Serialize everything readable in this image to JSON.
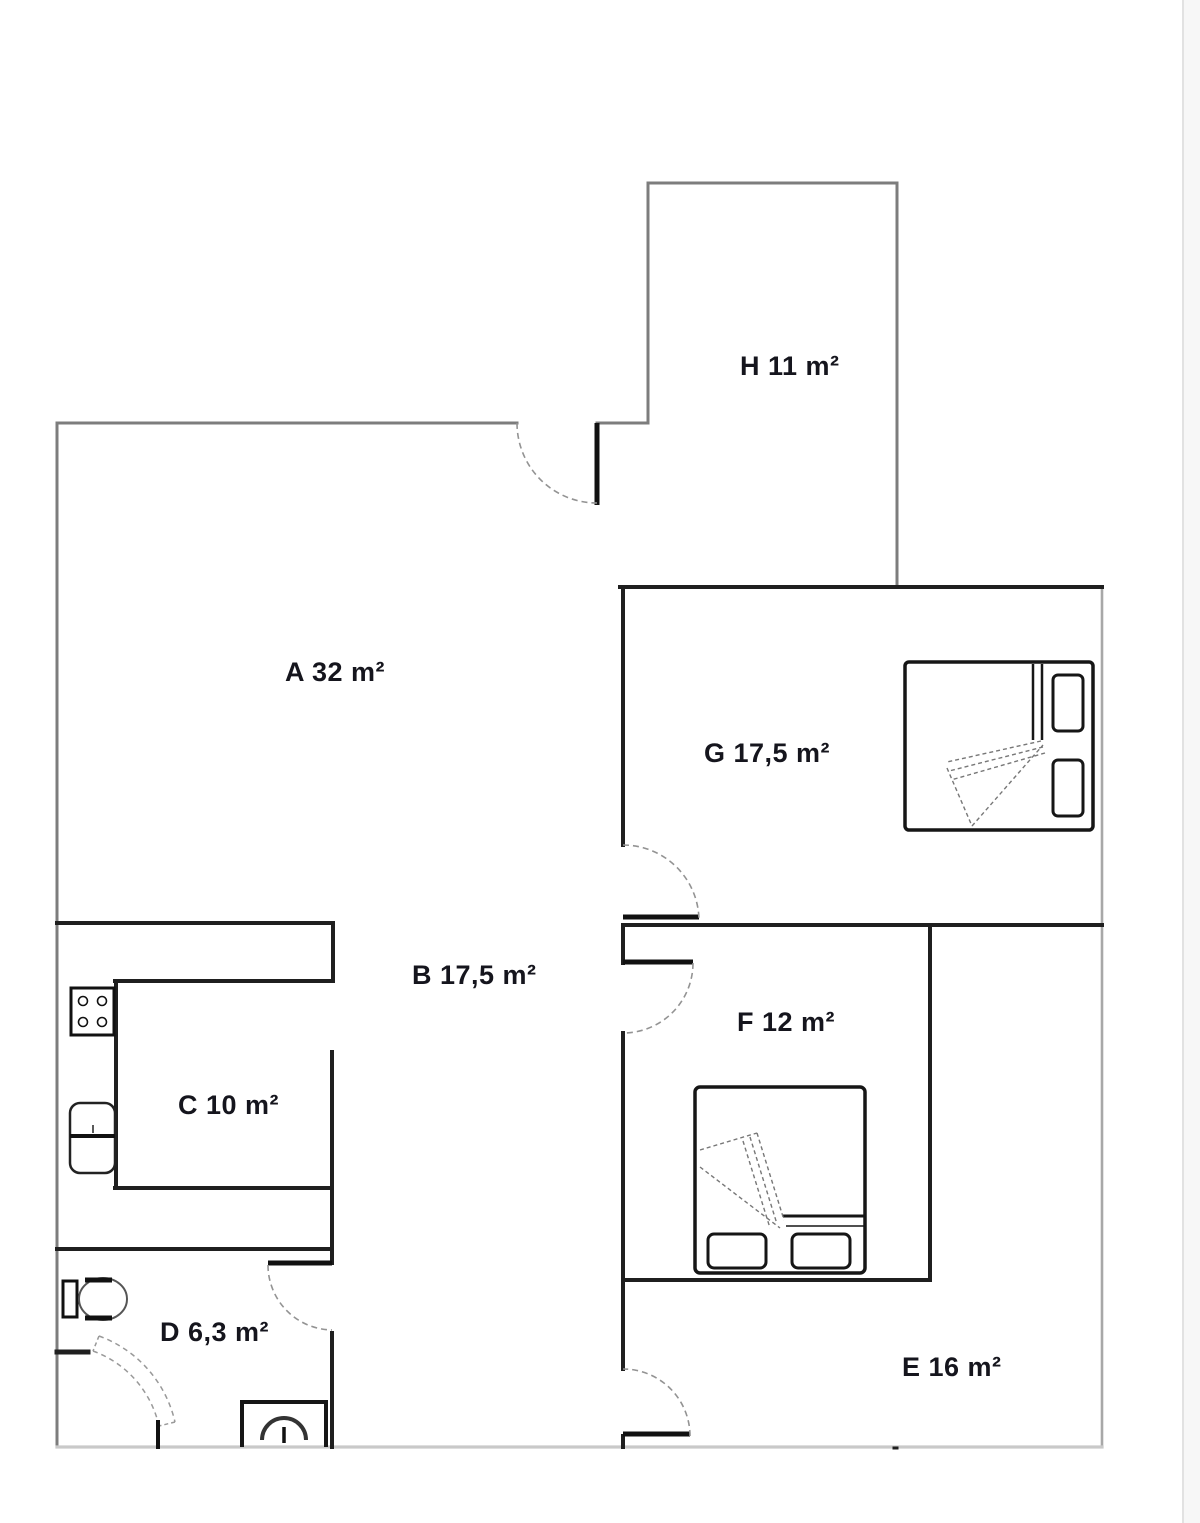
{
  "document": {
    "type": "floor-plan",
    "background": "#ffffff"
  },
  "floor_plan": {
    "rooms": [
      {
        "id": "A",
        "label": "A 32 m²"
      },
      {
        "id": "B",
        "label": "B 17,5 m²"
      },
      {
        "id": "C",
        "label": "C 10 m²"
      },
      {
        "id": "D",
        "label": "D 6,3 m²"
      },
      {
        "id": "E",
        "label": "E 16 m²"
      },
      {
        "id": "F",
        "label": "F 12 m²"
      },
      {
        "id": "G",
        "label": "G 17,5 m²"
      },
      {
        "id": "H",
        "label": "H 11 m²"
      }
    ],
    "icons": {
      "double-bed": "rounded rectangle with pillows and folded blanket",
      "stove": "square with four burner circles",
      "sink": "rounded rectangle with center divider",
      "toilet": "tank rectangle with oval bowl",
      "shower": "open square with drain dome",
      "door-swing": "quarter-circle dashed arc with leaf line"
    },
    "colors": {
      "wall_interior": "#1f1f1f",
      "wall_exterior_gray": "#7d7d7d",
      "wall_right_gray": "#a8a8a8",
      "wall_bottom_light": "#c9c9c9",
      "door_arc": "#939393",
      "furniture_outline": "#161616",
      "label_text": "#15151d",
      "page_edge": "#e2e2e2",
      "page_margin_fill": "#f7f7f7"
    }
  }
}
